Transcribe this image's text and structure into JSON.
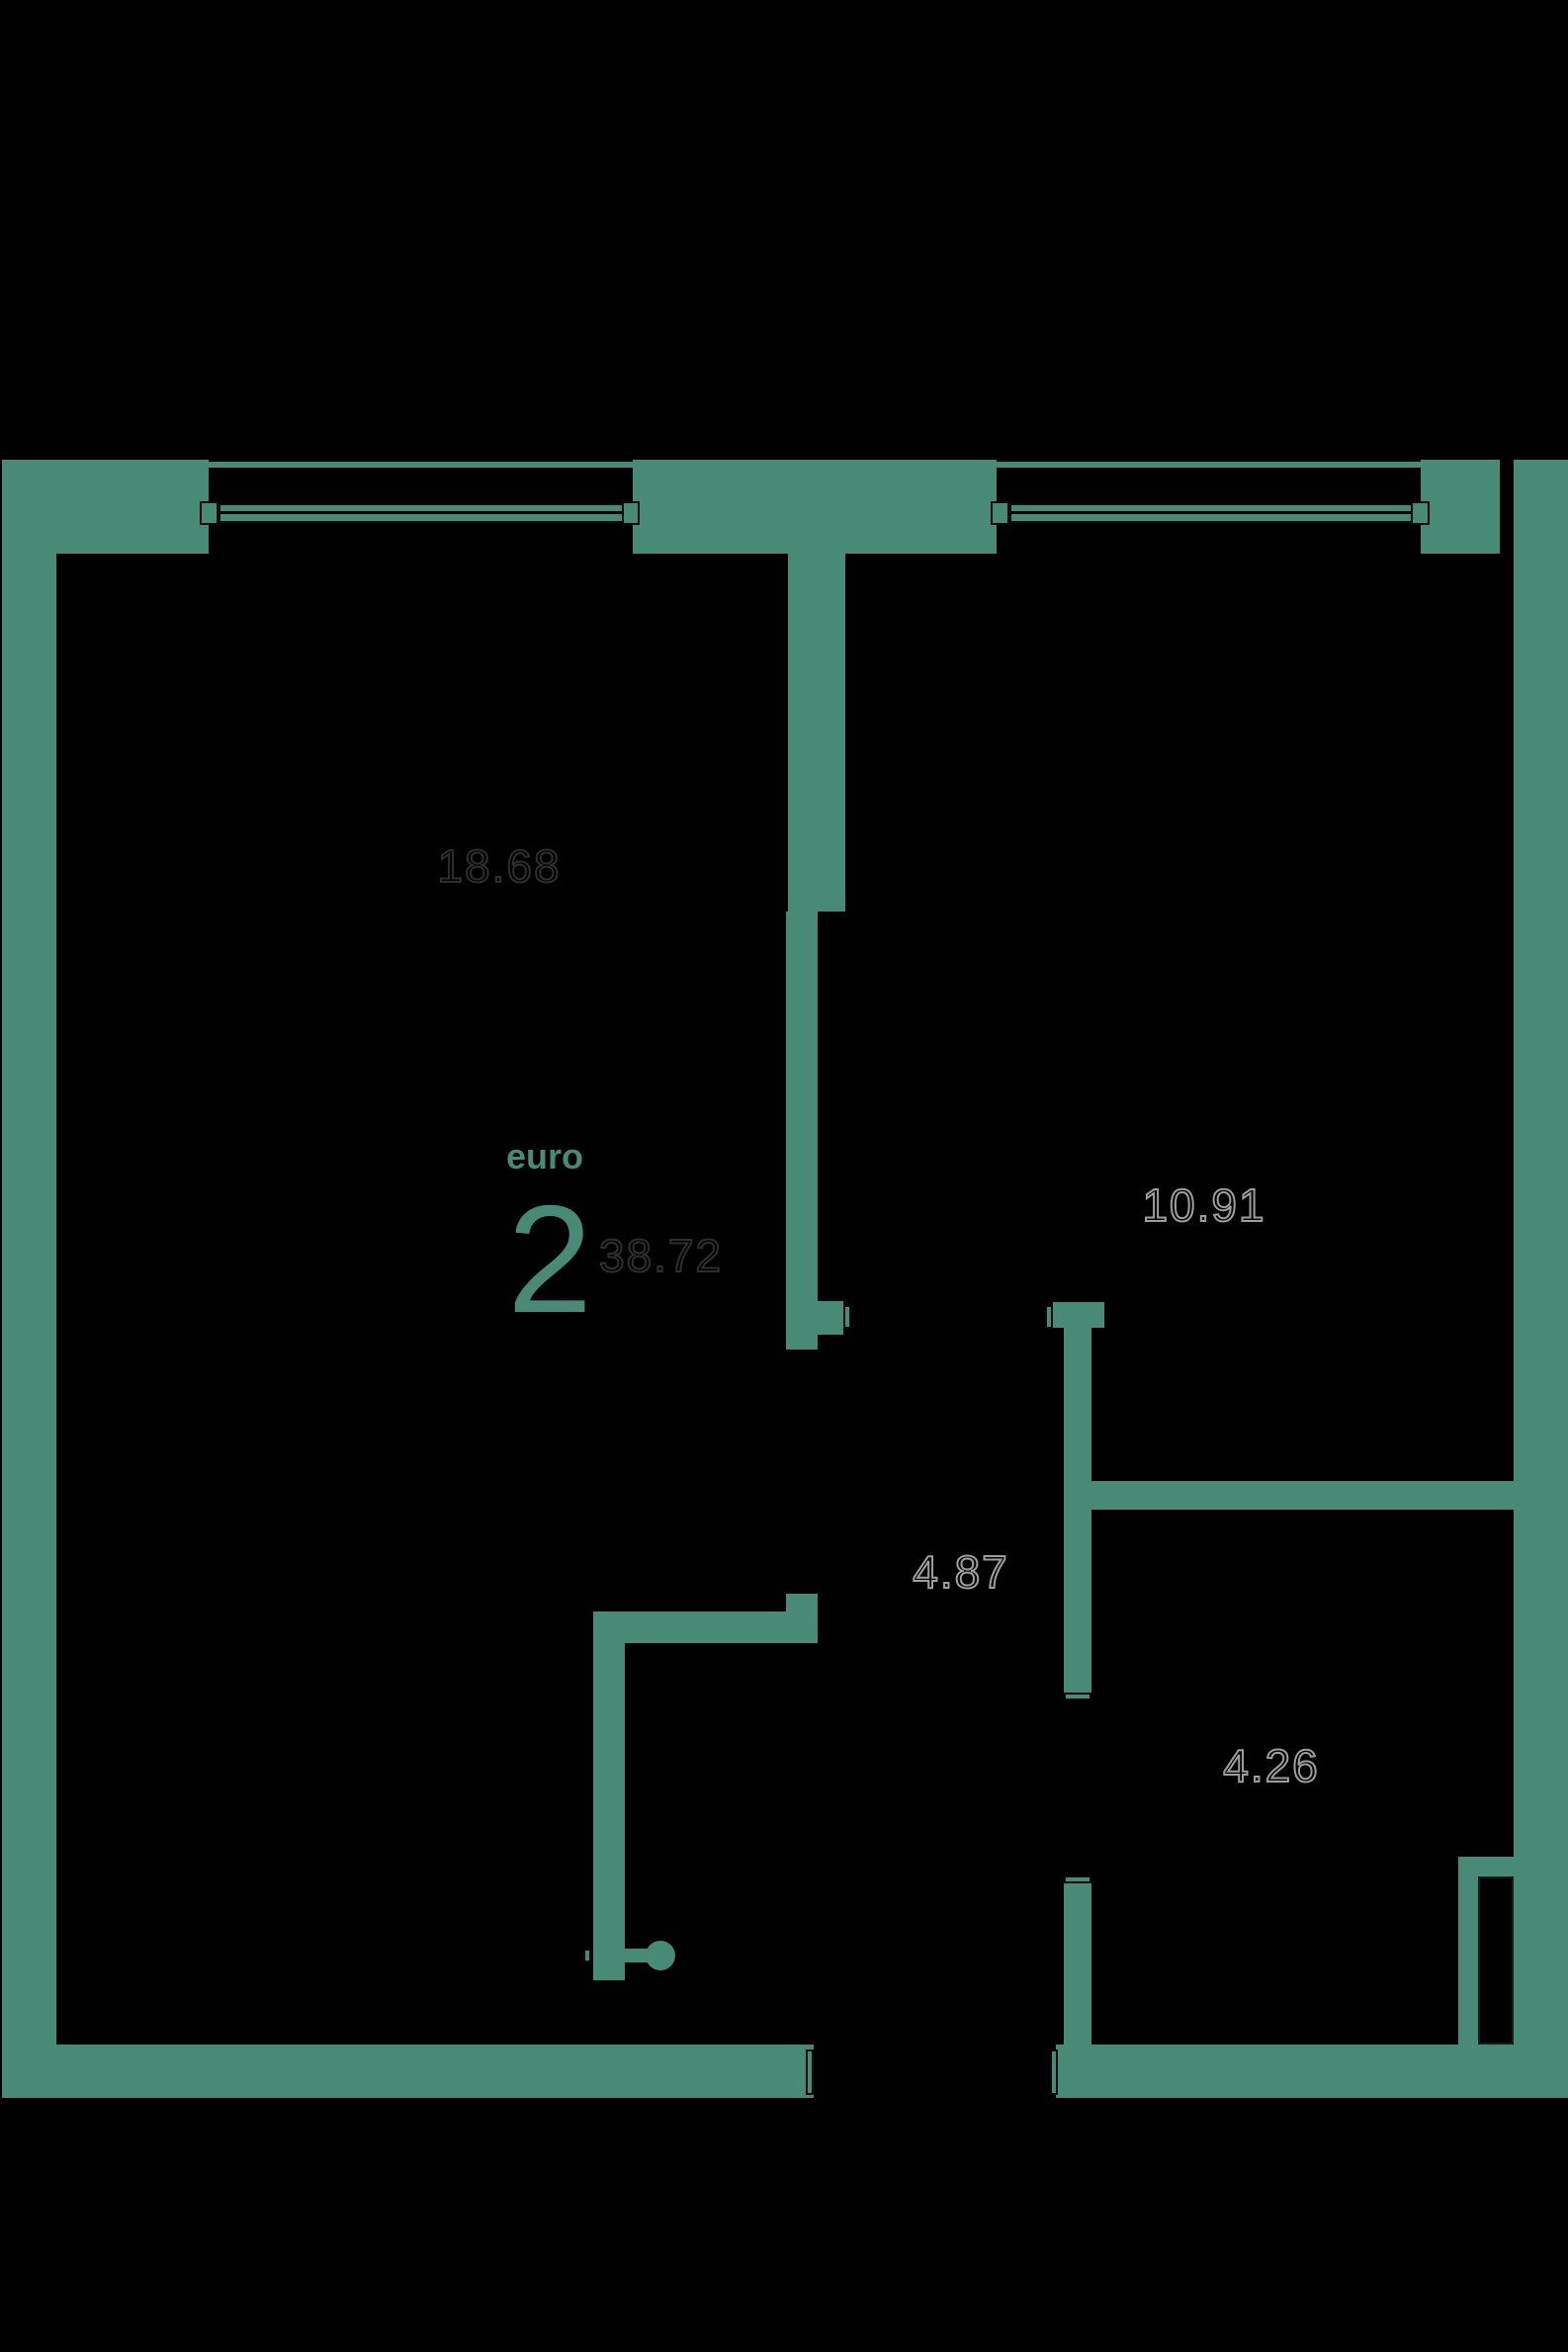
{
  "floorplan": {
    "unit_type_label": "euro",
    "unit_rooms_count": "2",
    "total_area": "38.72",
    "rooms": [
      {
        "name": "living-room",
        "area": "18.68"
      },
      {
        "name": "bedroom",
        "area": "10.91"
      },
      {
        "name": "hallway",
        "area": "4.87"
      },
      {
        "name": "bathroom",
        "area": "4.26"
      }
    ],
    "colors": {
      "wall": "#478b77",
      "background": "#000000",
      "area_text_dark": "#2e2e2e",
      "area_text_light": "#9e9e9e",
      "accent_text": "#478b77"
    }
  }
}
